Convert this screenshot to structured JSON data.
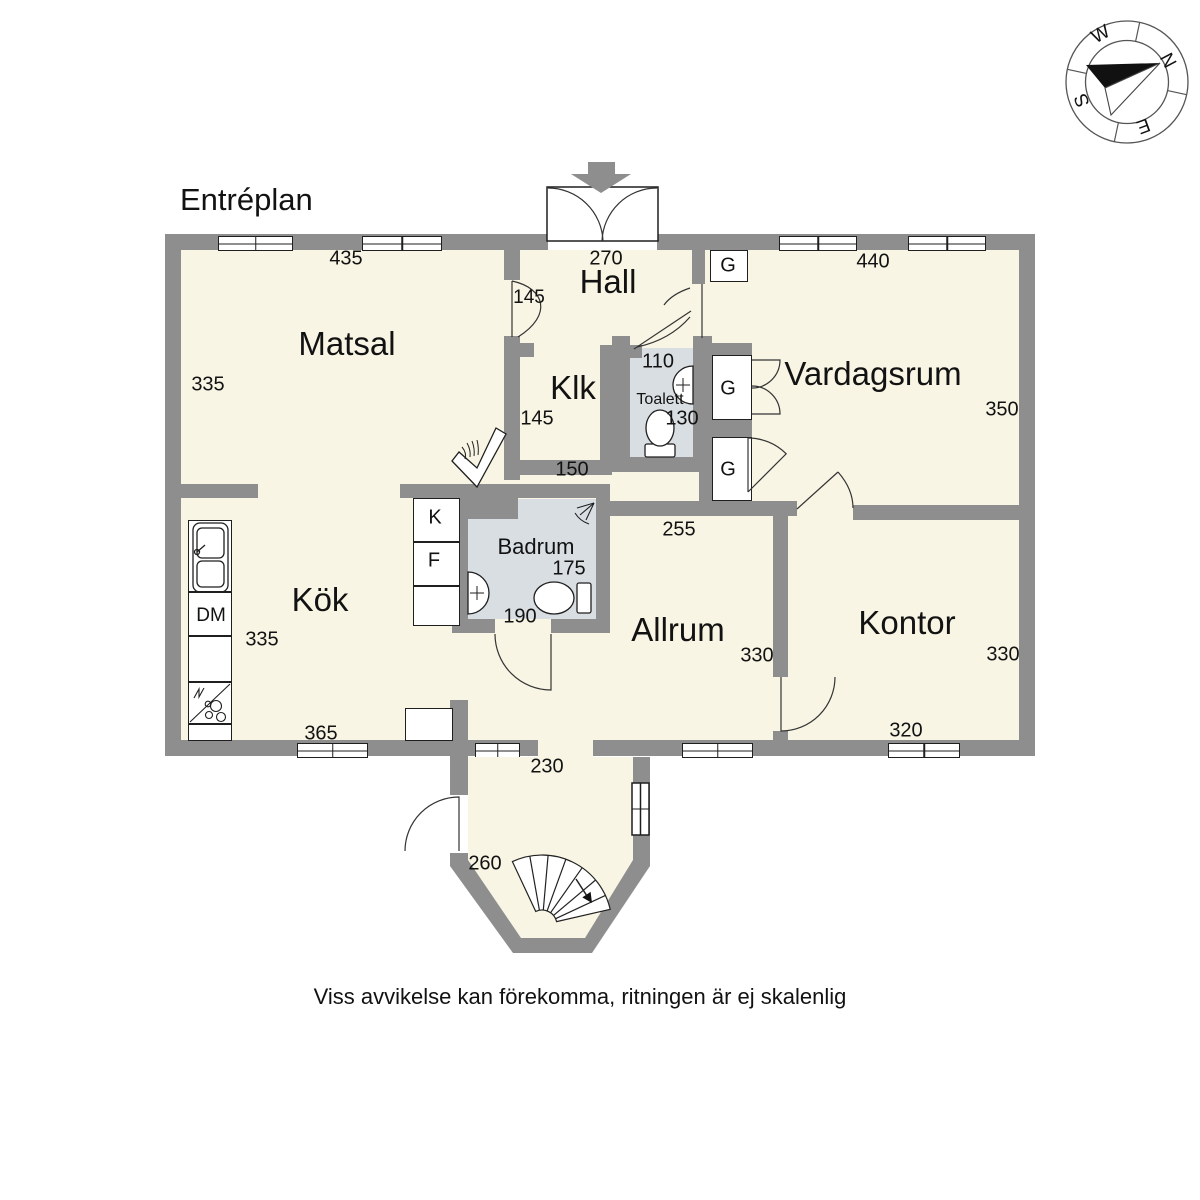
{
  "title": "Entréplan",
  "note": "Viss avvikelse kan förekomma, ritningen är ej skalenlig",
  "compass": {
    "n": "N",
    "e": "E",
    "s": "S",
    "w": "W"
  },
  "rooms": {
    "matsal": {
      "name": "Matsal",
      "width": "435",
      "depth": "335"
    },
    "hall": {
      "name": "Hall",
      "width": "270",
      "door": "145"
    },
    "klk": {
      "name": "Klk",
      "depth": "145",
      "width": "150"
    },
    "toalett": {
      "name": "Toalett",
      "width": "110",
      "depth": "130"
    },
    "vardagsrum": {
      "name": "Vardagsrum",
      "width": "440",
      "depth": "350"
    },
    "kok": {
      "name": "Kök",
      "depth": "335",
      "width": "365"
    },
    "badrum": {
      "name": "Badrum",
      "depth": "175",
      "width": "190"
    },
    "allrum": {
      "name": "Allrum",
      "opening": "255",
      "depth": "330"
    },
    "kontor": {
      "name": "Kontor",
      "depth": "330",
      "width": "320"
    },
    "trapp": {
      "width": "230",
      "depth": "260"
    }
  },
  "fixtures": {
    "garderob": "G",
    "kyl": "K",
    "frys": "F",
    "diskmaskin": "DM"
  }
}
